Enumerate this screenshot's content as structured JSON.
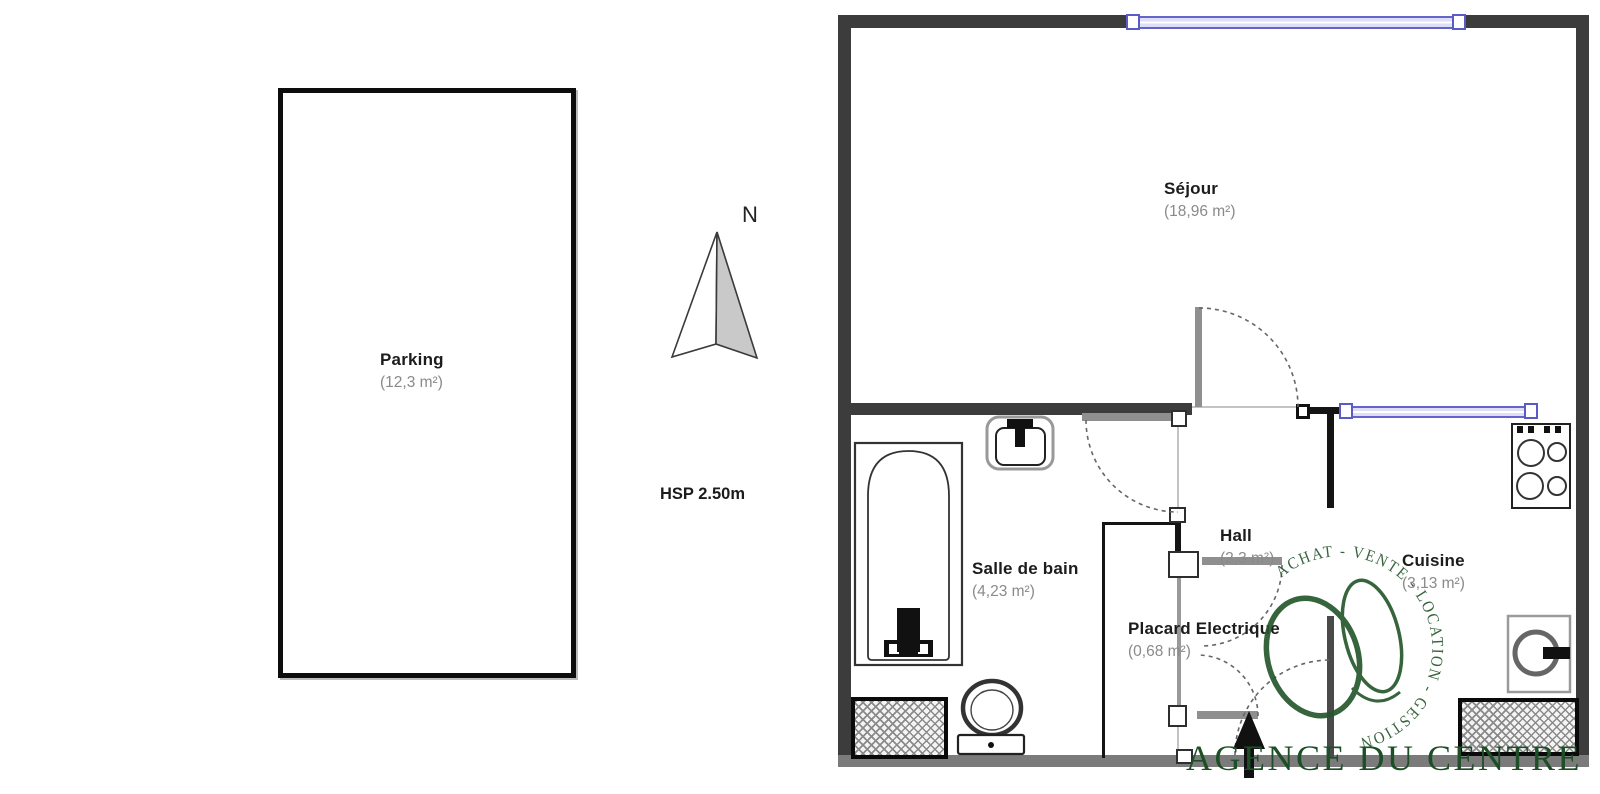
{
  "plan": {
    "rooms": [
      {
        "id": "sejour",
        "name": "Séjour",
        "area": "(18,96 m²)"
      },
      {
        "id": "salle_de_bain",
        "name": "Salle de bain",
        "area": "(4,23 m²)"
      },
      {
        "id": "hall",
        "name": "Hall",
        "area": "(2,3 m²)"
      },
      {
        "id": "placard",
        "name": "Placard Electrique",
        "area": "(0,68 m²)"
      },
      {
        "id": "cuisine",
        "name": "Cuisine",
        "area": "(3,13 m²)"
      },
      {
        "id": "parking",
        "name": "Parking",
        "area": "(12,3 m²)"
      }
    ],
    "annotations": {
      "north": "N",
      "ceiling_height": "HSP 2.50m"
    },
    "colors": {
      "wall": "#3c3c3c",
      "window_frame": "#6464cc",
      "window_fill": "#dedef6",
      "area_text": "#8a8a8a",
      "watermark_green": "#26572c"
    }
  },
  "watermark": {
    "ring_text": "ACHAT - VENTE - LOCATION - GESTION",
    "agency": "AGENCE DU CENTRE"
  }
}
